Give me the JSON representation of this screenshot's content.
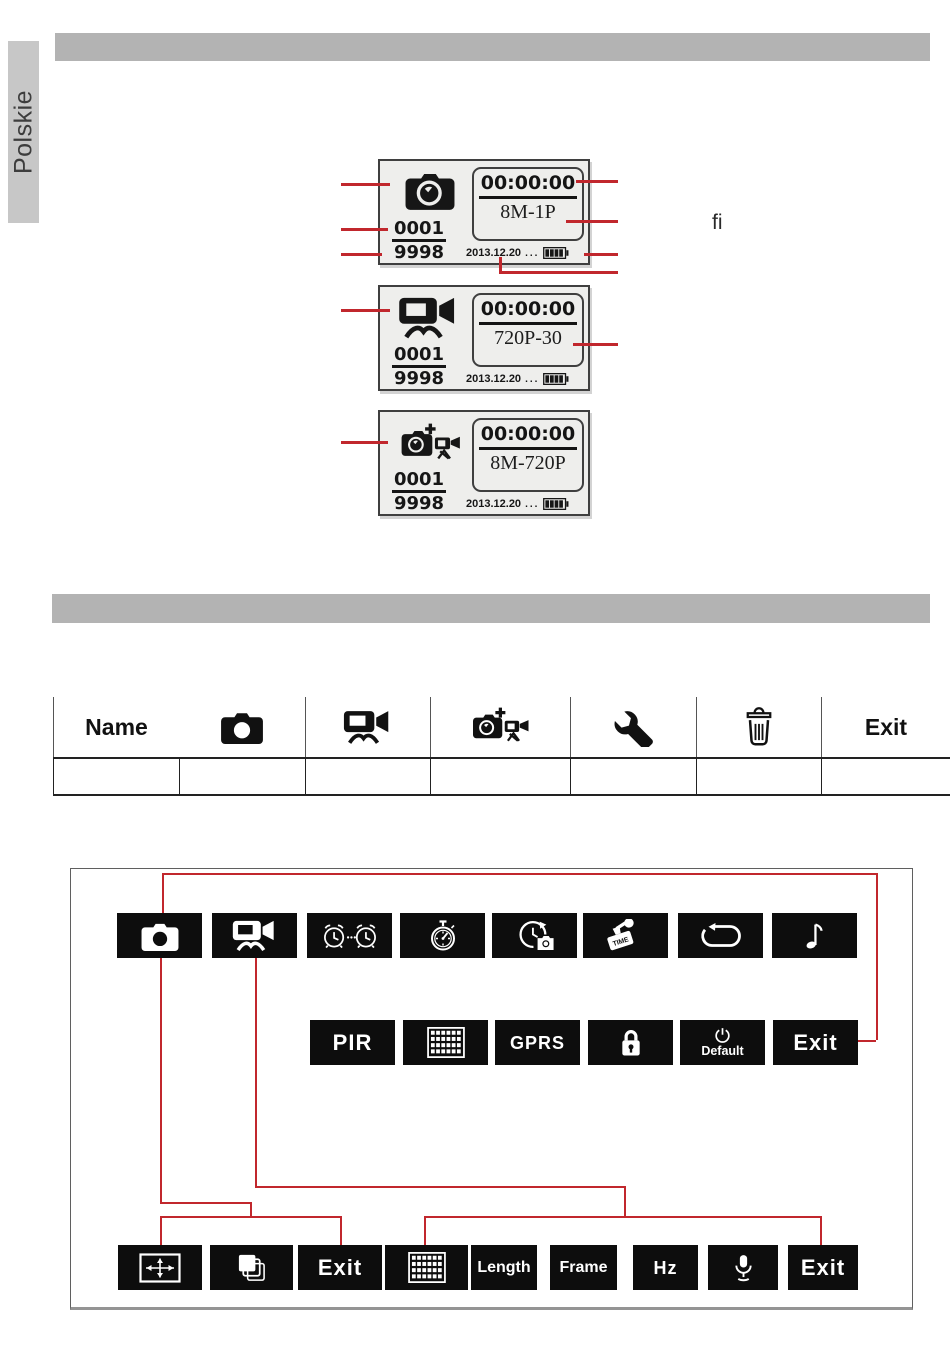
{
  "page": {
    "language_tab": "Polskie",
    "fi_text": "fi"
  },
  "colors": {
    "accent_red": "#c1272d",
    "bar_gray": "#b3b3b3",
    "tab_gray": "#c7c7c7",
    "tile_black": "#0d0d0d"
  },
  "screens": [
    {
      "name": "photo-mode-screen",
      "icon": "camera-lens",
      "battery": "battery",
      "counter_top": "0001",
      "counter_bottom": "9998",
      "time": "00:00:00",
      "mode": "8M-1P",
      "date": "2013.12.20",
      "ellipsis": "..."
    },
    {
      "name": "video-mode-screen",
      "icon": "video-camera",
      "battery": "battery",
      "counter_top": "0001",
      "counter_bottom": "9998",
      "time": "00:00:00",
      "mode": "720P-30",
      "date": "2013.12.20",
      "ellipsis": "..."
    },
    {
      "name": "photo-video-mode-screen",
      "icon": "camera-plus-video",
      "battery": "battery",
      "counter_top": "0001",
      "counter_bottom": "9998",
      "time": "00:00:00",
      "mode": "8M-720P",
      "date": "2013.12.20",
      "ellipsis": "..."
    }
  ],
  "table": {
    "header": [
      {
        "label": "Name"
      },
      {
        "icon": "camera"
      },
      {
        "icon": "video-camera"
      },
      {
        "icon": "camera-plus-video"
      },
      {
        "icon": "wrench"
      },
      {
        "icon": "trash"
      },
      {
        "label": "Exit"
      }
    ]
  },
  "menu": {
    "row1": [
      {
        "icon": "camera"
      },
      {
        "icon": "video-camera"
      },
      {
        "icon": "alarm-clocks"
      },
      {
        "icon": "stopwatch"
      },
      {
        "icon": "timelapse-camera"
      },
      {
        "icon": "time-stamp",
        "stamp_text": "TIME"
      },
      {
        "icon": "loop"
      },
      {
        "icon": "music-note"
      }
    ],
    "row2": [
      {
        "label": "PIR"
      },
      {
        "icon": "grid"
      },
      {
        "label": "GPRS"
      },
      {
        "icon": "lock"
      },
      {
        "icon": "power",
        "label": "Default"
      },
      {
        "label": "Exit"
      }
    ],
    "row3": [
      {
        "icon": "resolution"
      },
      {
        "icon": "burst"
      },
      {
        "label": "Exit"
      },
      {
        "icon": "grid"
      },
      {
        "label": "Length"
      },
      {
        "label": "Frame"
      },
      {
        "label": "Hz"
      },
      {
        "icon": "microphone"
      },
      {
        "label": "Exit"
      }
    ]
  }
}
